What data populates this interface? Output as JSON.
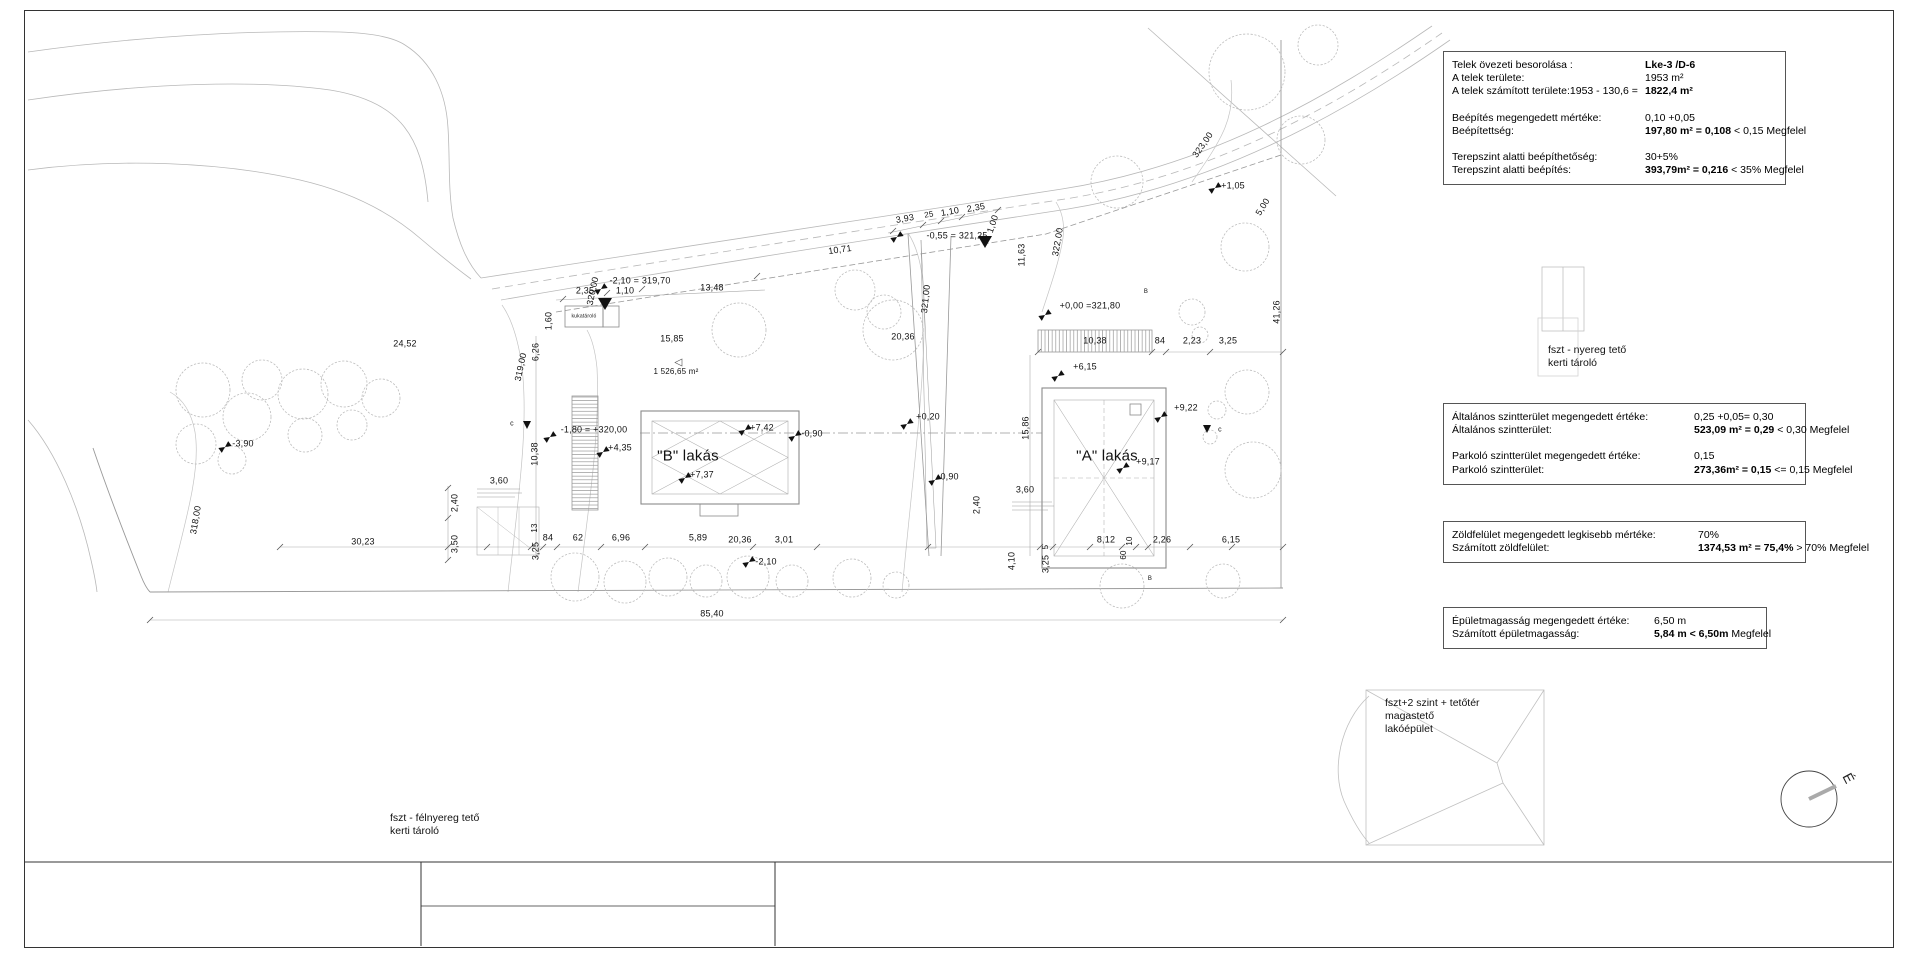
{
  "colors": {
    "line_light": "#bdbdbd",
    "line_mid": "#999999",
    "line_dark": "#333333",
    "text": "#111111"
  },
  "boxes": {
    "zoning": {
      "rows": [
        {
          "label": "Telek övezeti besorolása :",
          "bold": "Lke-3 /D-6"
        },
        {
          "label": "A telek területe:",
          "pre": "1953 m²"
        },
        {
          "label": "A telek számított területe:1953 - 130,6 = ",
          "bold": "1822,4 m²"
        },
        {
          "label": "Beépítés megengedett mértéke:",
          "pre": "0,10 +0,05",
          "gap": true
        },
        {
          "label": "Beépítettség:",
          "bold": "197,80 m² = 0,108",
          "post": " < 0,15 Megfelel"
        },
        {
          "label": "Terepszint alatti beépíthetőség:",
          "pre": "30+5%",
          "gap": true
        },
        {
          "label": "Terepszint alatti beépítés:",
          "bold": "393,79m² = 0,216",
          "post": " < 35%  Megfelel"
        }
      ]
    },
    "floor_area": {
      "rows": [
        {
          "label": "Általános szintterület megengedett értéke:",
          "pre": "0,25 +0,05= 0,30"
        },
        {
          "label": "Általános szintterület:",
          "bold": "523,09 m²  = 0,29",
          "post": " < 0,30 Megfelel"
        },
        {
          "label": "Parkoló szintterület megengedett értéke:",
          "pre": "0,15",
          "gap": true
        },
        {
          "label": "Parkoló szintterület:",
          "bold": "273,36m²  = 0,15",
          "post": " <= 0,15  Megfelel"
        }
      ]
    },
    "green": {
      "rows": [
        {
          "label": "Zöldfelület megengedett legkisebb mértéke:",
          "pre": "70%"
        },
        {
          "label": "Számított zöldfelület:",
          "bold": "1374,53 m² = 75,4%",
          "post": " > 70% Megfelel"
        }
      ]
    },
    "height": {
      "rows": [
        {
          "label": "Épületmagasság megengedett értéke:",
          "pre": "6,50 m"
        },
        {
          "label": "Számított épületmagasság:",
          "bold": "5,84 m <  6,50m",
          "post": "  Megfelel"
        }
      ]
    }
  },
  "notes": {
    "shed_right": "fszt - nyereg tető\nkerti tároló",
    "main_building": "fszt+2 szint + tetőtér\nmagastető\nlakóépület",
    "shed_left": "fszt - félnyereg tető\nkerti tároló",
    "north": "É"
  },
  "plan_labels": [
    {
      "t": "-2,10 = 319,70",
      "x": 640,
      "y": 281
    },
    {
      "t": "2,35",
      "x": 585,
      "y": 291
    },
    {
      "t": "1,10",
      "x": 625,
      "y": 291
    },
    {
      "t": "13,48",
      "x": 712,
      "y": 288
    },
    {
      "t": "15,85",
      "x": 672,
      "y": 339
    },
    {
      "t": "24,52",
      "x": 405,
      "y": 344
    },
    {
      "t": "-3,90",
      "x": 243,
      "y": 444
    },
    {
      "t": "30,23",
      "x": 363,
      "y": 542
    },
    {
      "t": "85,40",
      "x": 712,
      "y": 614
    },
    {
      "t": "1,60",
      "x": 549,
      "y": 321,
      "rot": -90
    },
    {
      "t": "6,26",
      "x": 536,
      "y": 352,
      "rot": -90
    },
    {
      "t": "319,00",
      "x": 521,
      "y": 367,
      "rot": -78
    },
    {
      "t": "320,00",
      "x": 593,
      "y": 291,
      "rot": -78
    },
    {
      "t": "318,00",
      "x": 196,
      "y": 520,
      "rot": -80
    },
    {
      "t": "1 526,65 m²",
      "x": 676,
      "y": 372,
      "size": 8
    },
    {
      "t": "kukatároló",
      "x": 584,
      "y": 317,
      "size": 5
    },
    {
      "t": "-1,80 = +320,00",
      "x": 594,
      "y": 430
    },
    {
      "t": "+4,35",
      "x": 620,
      "y": 448
    },
    {
      "t": "\"B\" lakás",
      "x": 688,
      "y": 456,
      "size": 15
    },
    {
      "t": "+7,37",
      "x": 702,
      "y": 475
    },
    {
      "t": "+7,42",
      "x": 762,
      "y": 428
    },
    {
      "t": "-0,90",
      "x": 812,
      "y": 434
    },
    {
      "t": "10,38",
      "x": 535,
      "y": 454,
      "rot": -90
    },
    {
      "t": "3,60",
      "x": 499,
      "y": 481
    },
    {
      "t": "2,40",
      "x": 455,
      "y": 503,
      "rot": -90
    },
    {
      "t": "3,50",
      "x": 455,
      "y": 544,
      "rot": -90
    },
    {
      "t": "13",
      "x": 535,
      "y": 528,
      "rot": -90,
      "size": 8
    },
    {
      "t": "3,25",
      "x": 536,
      "y": 551,
      "rot": -90
    },
    {
      "t": "84",
      "x": 548,
      "y": 538
    },
    {
      "t": "62",
      "x": 578,
      "y": 538
    },
    {
      "t": "6,96",
      "x": 621,
      "y": 538
    },
    {
      "t": "5,89",
      "x": 698,
      "y": 538
    },
    {
      "t": "3,01",
      "x": 784,
      "y": 540
    },
    {
      "t": "20,36",
      "x": 740,
      "y": 540
    },
    {
      "t": "-2,10",
      "x": 766,
      "y": 562
    },
    {
      "t": "10,71",
      "x": 840,
      "y": 250,
      "rot": -8
    },
    {
      "t": "3,93",
      "x": 905,
      "y": 219,
      "rot": -10
    },
    {
      "t": "25",
      "x": 929,
      "y": 215,
      "rot": -10,
      "size": 8
    },
    {
      "t": "1,10",
      "x": 950,
      "y": 212,
      "rot": -10
    },
    {
      "t": "2,35",
      "x": 976,
      "y": 208,
      "rot": -10
    },
    {
      "t": "1,00",
      "x": 993,
      "y": 224,
      "rot": -72
    },
    {
      "t": "-0,55 = 321,25",
      "x": 957,
      "y": 236
    },
    {
      "t": "321,00",
      "x": 926,
      "y": 299,
      "rot": -84
    },
    {
      "t": "20,36",
      "x": 903,
      "y": 337
    },
    {
      "t": "+0,20",
      "x": 928,
      "y": 417
    },
    {
      "t": "-0,90",
      "x": 948,
      "y": 477
    },
    {
      "t": "2,40",
      "x": 977,
      "y": 505,
      "rot": -90
    },
    {
      "t": "3,60",
      "x": 1025,
      "y": 490
    },
    {
      "t": "4,10",
      "x": 1012,
      "y": 561,
      "rot": -90
    },
    {
      "t": "3,25",
      "x": 1046,
      "y": 564,
      "rot": -90
    },
    {
      "t": "5",
      "x": 1046,
      "y": 547,
      "rot": -90,
      "size": 8
    },
    {
      "t": "8,12",
      "x": 1106,
      "y": 540
    },
    {
      "t": "60",
      "x": 1124,
      "y": 555,
      "rot": -90,
      "size": 8
    },
    {
      "t": "10",
      "x": 1130,
      "y": 541,
      "rot": -90,
      "size": 8
    },
    {
      "t": "2,26",
      "x": 1162,
      "y": 540
    },
    {
      "t": "6,15",
      "x": 1231,
      "y": 540
    },
    {
      "t": "11,63",
      "x": 1022,
      "y": 255,
      "rot": -90
    },
    {
      "t": "322,00",
      "x": 1058,
      "y": 242,
      "rot": -80
    },
    {
      "t": "+0,00 =321,80",
      "x": 1090,
      "y": 306
    },
    {
      "t": "10,38",
      "x": 1095,
      "y": 341
    },
    {
      "t": "84",
      "x": 1160,
      "y": 341
    },
    {
      "t": "2,23",
      "x": 1192,
      "y": 341
    },
    {
      "t": "3,25",
      "x": 1228,
      "y": 341
    },
    {
      "t": "+6,15",
      "x": 1085,
      "y": 367
    },
    {
      "t": "\"A\" lakás",
      "x": 1107,
      "y": 456,
      "size": 15
    },
    {
      "t": "+9,22",
      "x": 1186,
      "y": 408
    },
    {
      "t": "+9,17",
      "x": 1148,
      "y": 462
    },
    {
      "t": "15,86",
      "x": 1026,
      "y": 428,
      "rot": -90
    },
    {
      "t": "41,26",
      "x": 1277,
      "y": 312,
      "rot": -90
    },
    {
      "t": "+1,05",
      "x": 1233,
      "y": 186
    },
    {
      "t": "5,00",
      "x": 1263,
      "y": 207,
      "rot": -58
    },
    {
      "t": "323,00",
      "x": 1203,
      "y": 145,
      "rot": -55
    },
    {
      "t": "c",
      "x": 512,
      "y": 424,
      "size": 7
    },
    {
      "t": "c",
      "x": 1220,
      "y": 430,
      "size": 7
    },
    {
      "t": "B",
      "x": 1146,
      "y": 292,
      "size": 6
    },
    {
      "t": "B",
      "x": 1150,
      "y": 579,
      "size": 6
    }
  ],
  "trees": [
    [
      203,
      390,
      27
    ],
    [
      247,
      417,
      24
    ],
    [
      196,
      444,
      20
    ],
    [
      262,
      380,
      20
    ],
    [
      303,
      394,
      25
    ],
    [
      344,
      384,
      23
    ],
    [
      381,
      398,
      19
    ],
    [
      305,
      435,
      17
    ],
    [
      232,
      460,
      14
    ],
    [
      352,
      425,
      15
    ],
    [
      739,
      330,
      27
    ],
    [
      893,
      330,
      30
    ],
    [
      855,
      290,
      20
    ],
    [
      884,
      312,
      17
    ],
    [
      575,
      577,
      24
    ],
    [
      625,
      582,
      21
    ],
    [
      668,
      577,
      19
    ],
    [
      706,
      581,
      16
    ],
    [
      748,
      577,
      21
    ],
    [
      792,
      581,
      16
    ],
    [
      852,
      578,
      19
    ],
    [
      896,
      585,
      13
    ],
    [
      1247,
      72,
      38
    ],
    [
      1301,
      140,
      24
    ],
    [
      1117,
      182,
      26
    ],
    [
      1245,
      247,
      24
    ],
    [
      1318,
      45,
      20
    ],
    [
      1192,
      312,
      13
    ],
    [
      1200,
      335,
      8
    ],
    [
      1247,
      392,
      22
    ],
    [
      1253,
      470,
      28
    ],
    [
      1122,
      586,
      22
    ],
    [
      1223,
      581,
      17
    ],
    [
      1217,
      410,
      9
    ],
    [
      1210,
      437,
      7
    ]
  ],
  "ticks": [
    [
      280,
      547
    ],
    [
      448,
      547
    ],
    [
      487,
      547
    ],
    [
      531,
      547
    ],
    [
      543,
      547
    ],
    [
      557,
      547
    ],
    [
      601,
      547
    ],
    [
      645,
      547
    ],
    [
      753,
      547
    ],
    [
      817,
      547
    ],
    [
      928,
      547
    ],
    [
      1040,
      547
    ],
    [
      1053,
      547
    ],
    [
      1090,
      547
    ],
    [
      1122,
      547
    ],
    [
      1136,
      547
    ],
    [
      1148,
      547
    ],
    [
      1190,
      547
    ],
    [
      1232,
      547
    ],
    [
      1283,
      547
    ],
    [
      150,
      620
    ],
    [
      1283,
      620
    ],
    [
      448,
      488
    ],
    [
      448,
      518
    ],
    [
      448,
      560
    ],
    [
      1038,
      352
    ],
    [
      1152,
      352
    ],
    [
      1166,
      352
    ],
    [
      1210,
      352
    ],
    [
      1283,
      352
    ],
    [
      563,
      299
    ],
    [
      607,
      293
    ],
    [
      642,
      289
    ],
    [
      757,
      276
    ],
    [
      893,
      231
    ],
    [
      923,
      225
    ],
    [
      941,
      221
    ],
    [
      962,
      217
    ],
    [
      998,
      210
    ]
  ],
  "flags": [
    [
      550,
      437
    ],
    [
      603,
      452
    ],
    [
      685,
      478
    ],
    [
      745,
      430
    ],
    [
      795,
      436
    ],
    [
      225,
      447
    ],
    [
      907,
      424
    ],
    [
      935,
      480
    ],
    [
      749,
      562
    ],
    [
      1045,
      315
    ],
    [
      1058,
      376
    ],
    [
      1161,
      417
    ],
    [
      1123,
      468
    ],
    [
      1215,
      188
    ],
    [
      897,
      237
    ],
    [
      601,
      289
    ]
  ]
}
